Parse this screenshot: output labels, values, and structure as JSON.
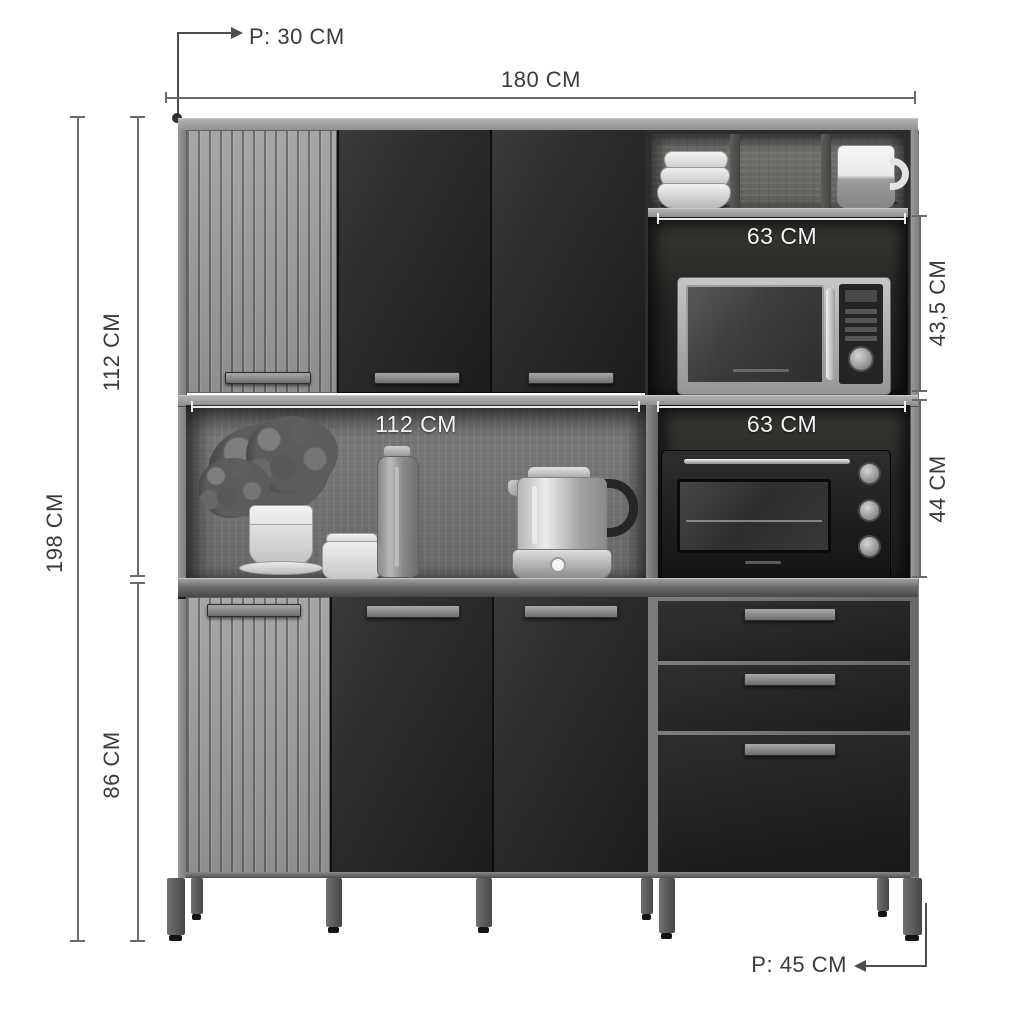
{
  "diagram": {
    "type": "furniture-dimension-diagram",
    "subject": "kitchen cabinet with microwave and oven niches"
  },
  "annotations": {
    "top_depth": "P: 30 CM",
    "total_width": "180 CM",
    "upper_section_height": "112 CM",
    "total_height": "198 CM",
    "base_height": "86 CM",
    "upper_niche_width": "63 CM",
    "upper_niche_height": "43,5 CM",
    "counter_niche_width": "112 CM",
    "oven_niche_width": "63 CM",
    "oven_niche_height": "44 CM",
    "base_depth": "P: 45 CM"
  },
  "colors": {
    "background": "#ffffff",
    "annotation_line": "#6a6a6a",
    "annotation_text": "#3b3b3b",
    "annotation_text_light": "#f4f4f4",
    "wood_light": "#9b9b9b",
    "wood_back": "#6f6f6d",
    "door_black": "#262626",
    "handle_gray": "#8a8a8a",
    "leg_gray": "#5a5a5a"
  }
}
